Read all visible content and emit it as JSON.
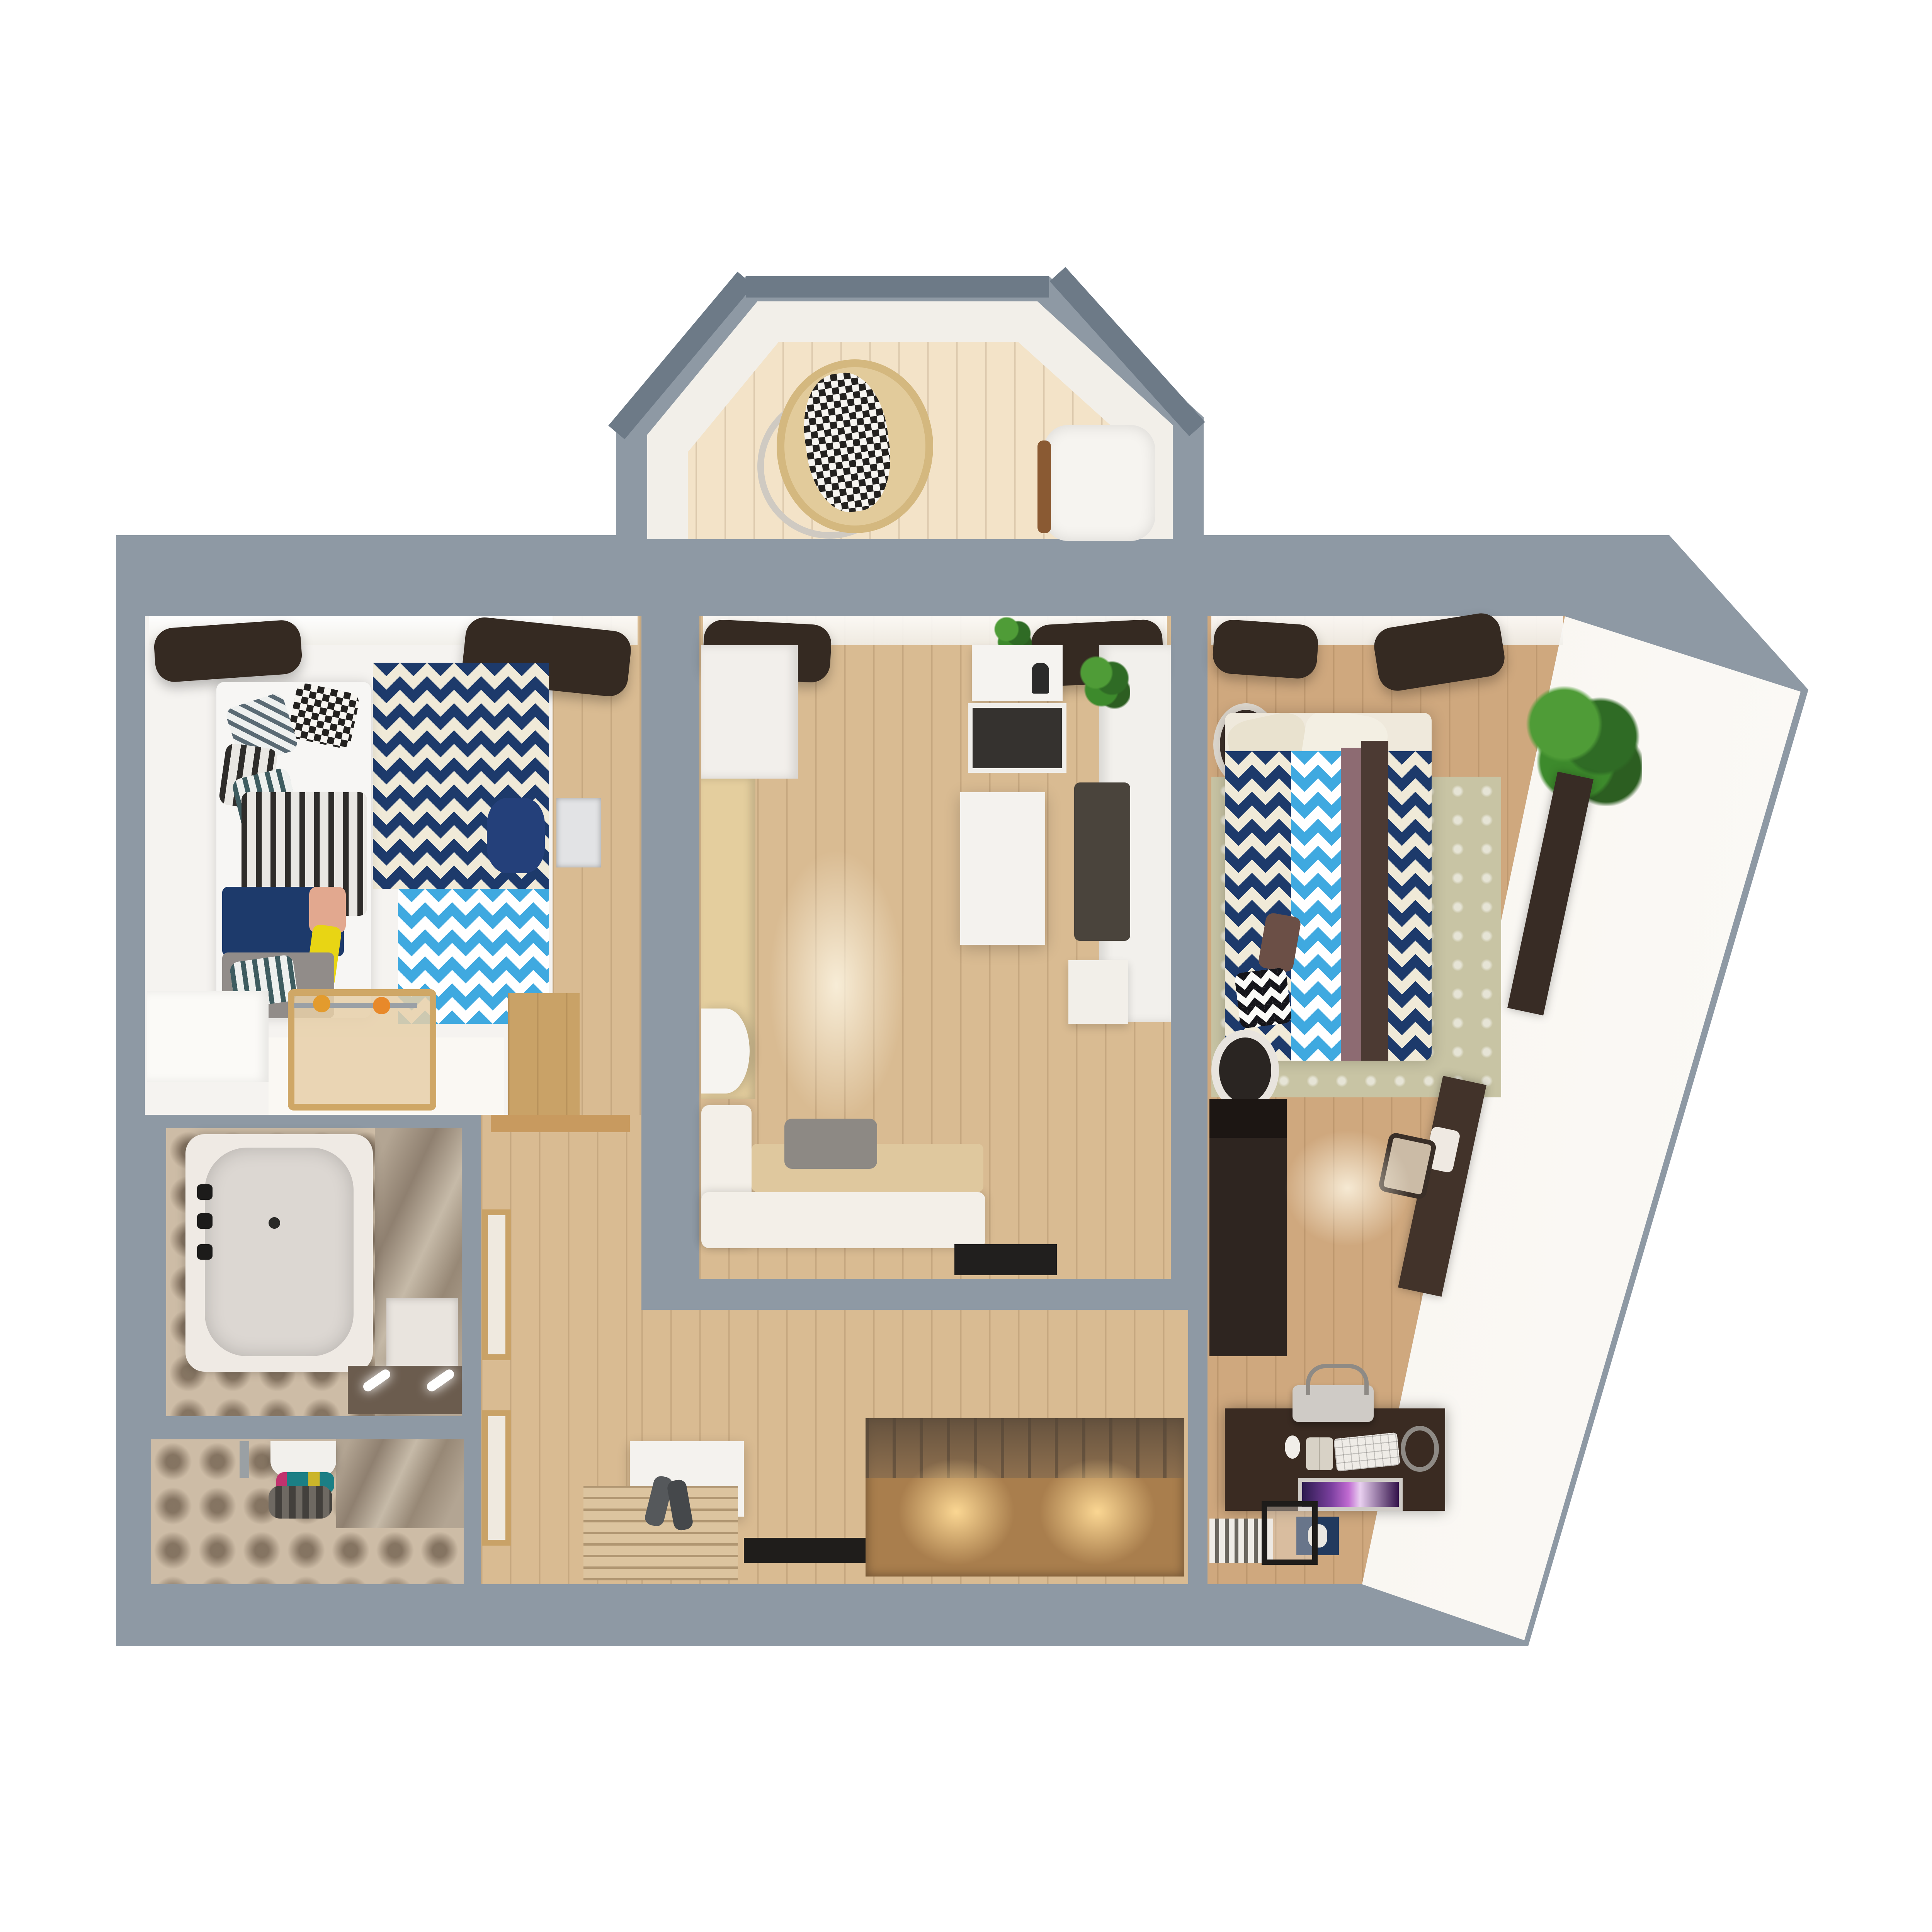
{
  "palette": {
    "bg": "#ffffff",
    "wall": "#8e99a4",
    "wallDark": "#6d7a87",
    "frameWhite": "#f2efe9",
    "floorPale": "#f3e3c8",
    "floorWood": "#d9bb92",
    "floorWood2": "#cfa87e",
    "floorWhite": "#f5f3f0",
    "wallFace": "#efe9e0",
    "cream": "#f0ead8",
    "navy": "#1d3a6b",
    "lblue": "#3fa9e0",
    "black": "#23211f",
    "tile": "#cdbca6",
    "sage": "#c8c4a4",
    "curtain": "#352a22",
    "sofa": "#f3efe8",
    "sofaSeat": "#dfc89e",
    "cushionGrey": "#8d8984",
    "counter": "#f2f0ec",
    "appliance": "#35322f",
    "wardrobeDark": "#2e2520",
    "deskBrown": "#3a2b22",
    "hallWardrobe": "#a97e4d",
    "doorWood": "#c9a267",
    "tub": "#efeae4",
    "tubInner": "#dcd7d2",
    "screenPurple": "#c06ad1"
  },
  "scene": {
    "type": "apartment-floor-plan-3d-render-top-view",
    "rooms": [
      {
        "name": "balcony",
        "items": [
          "window-frames",
          "hanging-rattan-chair",
          "checkered-blanket",
          "white-armchair"
        ]
      },
      {
        "name": "kids-bedroom",
        "items": [
          "dark-curtains",
          "bed",
          "checkered-pillow",
          "striped-pillows",
          "striped-duvet",
          "navy-throw",
          "grey-blanket",
          "yellow-pillow",
          "navy-chevron-rug",
          "blue-chevron-rug",
          "desk",
          "navy-desk-chair",
          "clothes-rack",
          "white-low-cabinet",
          "wood-door"
        ]
      },
      {
        "name": "kitchen-living-room",
        "items": [
          "dark-curtains",
          "plant",
          "white-wardrobe",
          "beige-cabinet",
          "round-table",
          "corner-sofa",
          "grey-cushion",
          "hood",
          "cooktop",
          "counter",
          "dark-runner",
          "island-table",
          "white-cabinet",
          "bottle",
          "corner-plant",
          "doormat"
        ]
      },
      {
        "name": "master-bedroom",
        "items": [
          "dark-curtains",
          "bedside-round-table",
          "double-bed-chevron",
          "headboard-pillows",
          "brown-throw",
          "mauve-pillow",
          "bw-chevron-pillow",
          "sage-damask-rug",
          "large-plant",
          "slanted-wall-console",
          "vanity-desk",
          "vanity-chair",
          "dark-wardrobe",
          "fan-object",
          "computer-desk",
          "printer",
          "keyboard",
          "monitor",
          "open-book",
          "mouse",
          "mic-arm",
          "book-row",
          "navy-box",
          "metal-stool"
        ]
      },
      {
        "name": "bathroom",
        "items": [
          "bathtub",
          "faucet-fixtures",
          "drain",
          "marble-wall",
          "washing-machine",
          "vanity-counter-lights"
        ]
      },
      {
        "name": "wc",
        "items": [
          "toilet",
          "colorful-towels",
          "chrome-radiator",
          "marble-wall",
          "door-strip"
        ]
      },
      {
        "name": "hallway",
        "items": [
          "doorway-threshold",
          "frosted-interior-door",
          "frosted-interior-door-2",
          "white-shoe-bench",
          "grey-shoes",
          "slatted-mat",
          "black-doormat",
          "lighted-wardrobe",
          "glass-top-hangers"
        ]
      }
    ]
  }
}
